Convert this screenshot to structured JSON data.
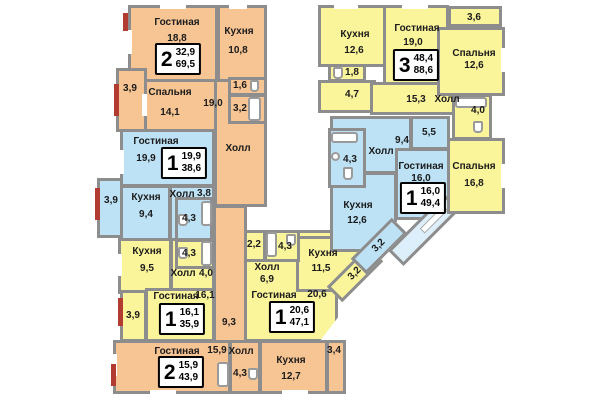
{
  "plan": {
    "type": "apartment-floor-plan",
    "language": "ru"
  },
  "colors": {
    "orange_flat": "#F7C494",
    "yellow_flat": "#FAF49B",
    "blue_flat": "#BDE2F5",
    "balcony_fill": "#DCEFFA",
    "wall": "#8d8d8d",
    "window_marker_red": "#B23B32",
    "text": "#1b1b1b",
    "badge_border": "#000000"
  },
  "apartments": [
    {
      "name": "2-room apartment top-left (orange)",
      "badge": {
        "rooms": "2",
        "living_area": "32,9",
        "total_area": "69,5"
      },
      "labels": {
        "living": "Гостиная",
        "living_area": "18,8",
        "kitchen": "Кухня",
        "kitchen_area": "10,8",
        "bedroom": "Спальня",
        "bedroom_area": "14,1",
        "hall": "Холл",
        "hall_area": "19,0",
        "wc_area": "1,6",
        "bath_area": "3,2",
        "balcony_area": "3,9"
      }
    },
    {
      "name": "1-room apartment left (blue)",
      "badge": {
        "rooms": "1",
        "living_area": "19,9",
        "total_area": "38,6"
      },
      "labels": {
        "living": "Гостиная",
        "living_area": "19,9",
        "kitchen": "Кухня",
        "kitchen_area": "9,4",
        "hall": "Холл",
        "hall_area": "3,8",
        "bath_area": "4,3",
        "balcony_area": "3,9"
      }
    },
    {
      "name": "1-room apartment lower-left (yellow)",
      "badge": {
        "rooms": "1",
        "living_area": "16,1",
        "total_area": "35,9"
      },
      "labels": {
        "kitchen": "Кухня",
        "kitchen_area": "9,5",
        "bath_area": "4,3",
        "hall": "Холл",
        "hall_area": "4,0",
        "living": "Гостиная",
        "living_area": "16,1",
        "balcony_area": "3,9"
      }
    },
    {
      "name": "2-room apartment bottom (orange)",
      "badge": {
        "rooms": "2",
        "living_area": "15,9",
        "total_area": "43,9"
      },
      "labels": {
        "corridor_area": "9,3",
        "living": "Гостиная",
        "living_area": "15,9",
        "hall": "Холл",
        "bath_area": "4,3",
        "kitchen": "Кухня",
        "kitchen_area": "12,7",
        "balcony_area": "3,4"
      }
    },
    {
      "name": "1-room apartment bottom-middle (yellow)",
      "badge": {
        "rooms": "1",
        "living_area": "20,6",
        "total_area": "47,1"
      },
      "labels": {
        "wc_area": "2,2",
        "bath_area": "4,3",
        "hall": "Холл",
        "hall_area": "6,9",
        "kitchen": "Кухня",
        "kitchen_area": "11,5",
        "loggia_area": "3,2",
        "living": "Гостиная",
        "living_area": "20,6"
      }
    },
    {
      "name": "1-room apartment middle (blue)",
      "badge": {
        "rooms": "1",
        "living_area": "16,0",
        "total_area": "49,4"
      },
      "labels": {
        "bath_area": "4,3",
        "hall": "Холл",
        "hall_area": "9,4",
        "pantry_area": "5,5",
        "living": "Гостиная",
        "living_area": "16,0",
        "kitchen": "Кухня",
        "kitchen_area": "12,6",
        "loggia_area": "3,2"
      }
    },
    {
      "name": "3-room apartment top-right (yellow)",
      "badge": {
        "rooms": "3",
        "living_area": "48,4",
        "total_area": "88,6"
      },
      "labels": {
        "kitchen": "Кухня",
        "kitchen_area": "12,6",
        "wc_area": "1,8",
        "bath2_area": "4,7",
        "living": "Гостиная",
        "living_area": "19,0",
        "hall_area": "15,3",
        "hall": "Холл",
        "balcony_area": "3,6",
        "bedroom1": "Спальня",
        "bedroom1_area": "12,6",
        "bath_area": "4,0",
        "bedroom2": "Спальня",
        "bedroom2_area": "16,8"
      }
    }
  ]
}
